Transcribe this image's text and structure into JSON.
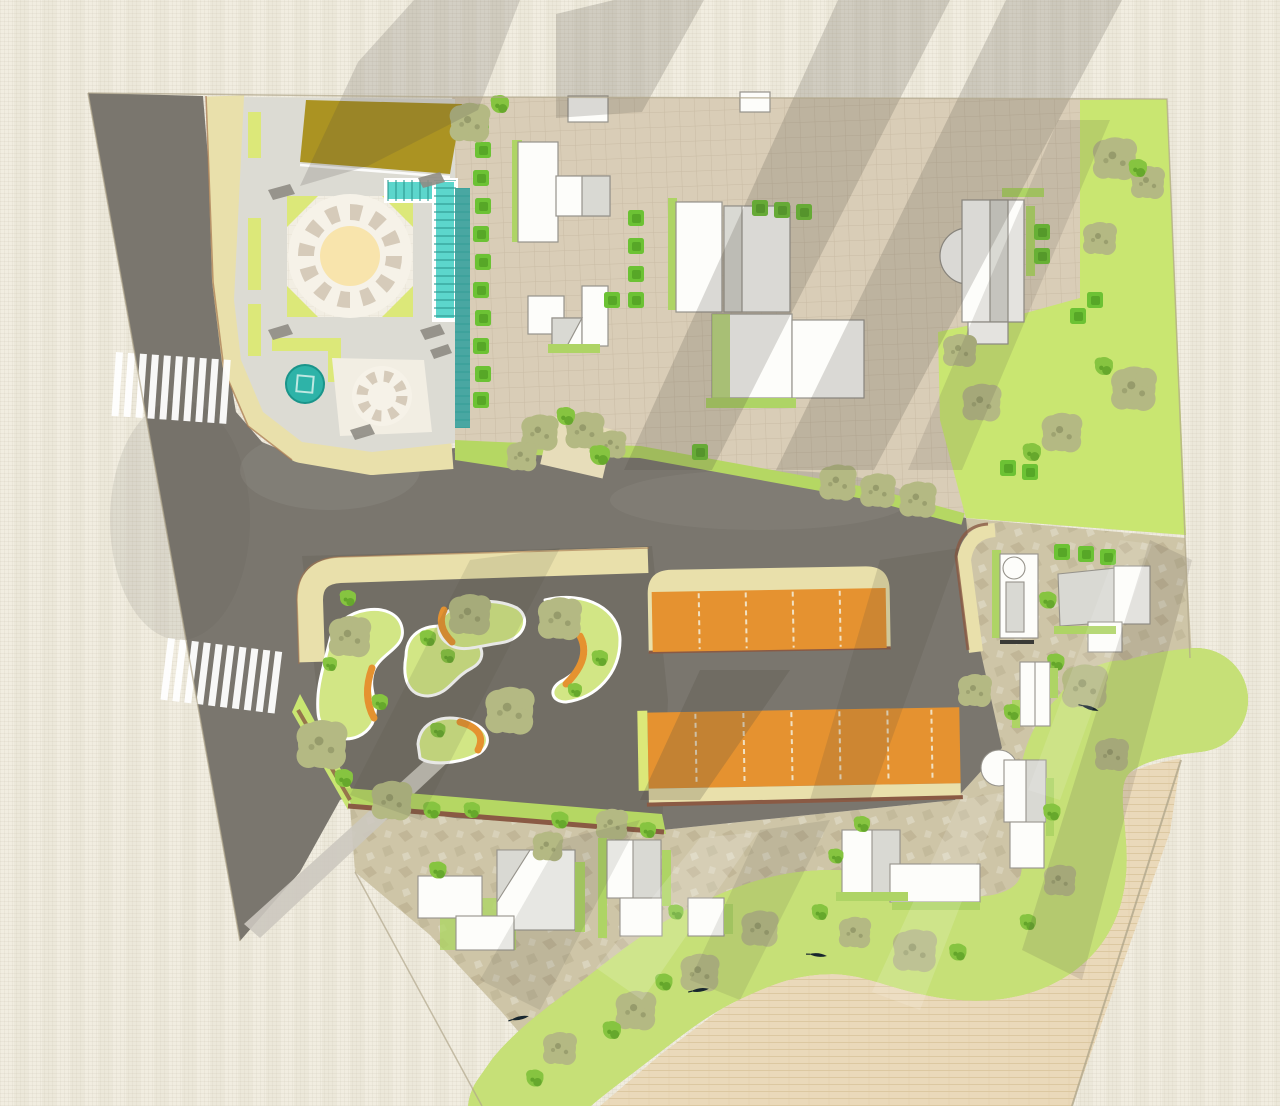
{
  "meta": {
    "title": "Urban riverfront landscape masterplan",
    "type": "top-down watercolor-style architectural site plan",
    "canvas": {
      "width": 1280,
      "height": 1106
    },
    "visible_text": "none"
  },
  "palette": {
    "paper": "#f0ecdf",
    "shadow": "#4e4a40",
    "shadowLight": "#8e897c",
    "road": "#7a766e",
    "roadDark": "#6b675f",
    "sidewalk": "#e9e0ab",
    "curb": "#a5754f",
    "plaza": "#dcdbd3",
    "plazaPave": "#f2eee3",
    "checker": "#d6cbba",
    "circleCenter": "#f8e4ac",
    "oliveLawn": "#ab9322",
    "stripGreen": "#dce879",
    "lawn": "#c9e671",
    "moundGreen": "#d2e685",
    "verge": "#b5d763",
    "pool": "#5cd6cc",
    "poolLine": "#2a9a90",
    "cascade": "#49a7a2",
    "fountain": "#2eb3a8",
    "hedge": "#6cc234",
    "hedgeDark": "#52a024",
    "treeOlive": "#b4b983",
    "treeOliveDark": "#8f9465",
    "treeGreen": "#86c440",
    "treeGreenDark": "#63a52a",
    "orange": "#e59230",
    "orangeDark": "#a96a1f",
    "brown": "#8a5a44",
    "stone": "#cec5a7",
    "stoneSpeckle": "#ab9f7d",
    "brick": "#ead9ba",
    "brickLine": "#d9c49b",
    "riverBank": "#c6e077",
    "river": "#2b6e96",
    "riverDeep": "#1d5479",
    "building": "#fdfdfa",
    "buildingStroke": "#96938b",
    "facet": "#d9d9d3",
    "facetDark": "#c4c4be",
    "buildingGreen": "#aed465",
    "boat": "#18262e",
    "gridLine": "#a8977b",
    "pavedGrid": "#d9cdb7",
    "edgeLine": "#b0a68c"
  },
  "features": {
    "streets": {
      "label": "street network",
      "crosswalk_count": 2
    },
    "plaza": {
      "label": "entry plaza with circular checker paving, lap pool, cascade and fountain"
    },
    "campus": {
      "label": "paved campus block with white buildings, hedges and lawns"
    },
    "pocket_park": {
      "label": "pocket park with planted mounds and orange curved benches",
      "mound_count": 5
    },
    "parking": {
      "label": "orange surface parking bays",
      "row_count": 2
    },
    "esplanade": {
      "label": "stone-paved riverside esplanade with pavilions"
    },
    "river": {
      "label": "river with sparkling water and rowing boats",
      "boat_count": 4
    },
    "waterfront": {
      "label": "brick-paved waterfront terrace"
    }
  }
}
